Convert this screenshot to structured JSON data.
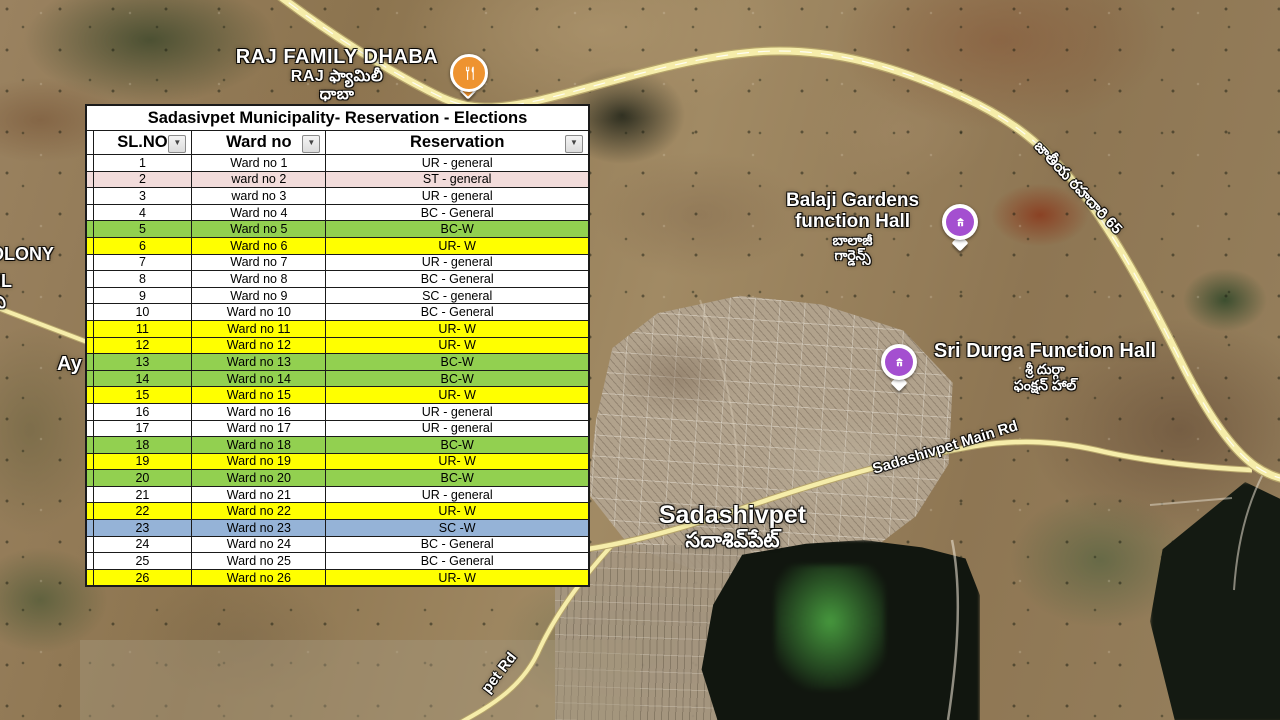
{
  "table": {
    "title": "Sadasivpet Municipality- Reservation - Elections",
    "columns": {
      "sl": "SL.NO",
      "ward": "Ward no",
      "res": "Reservation"
    },
    "filter_icon": "▼",
    "row_colors": {
      "white": "#ffffff",
      "pink": "#f2dcdb",
      "green": "#92d050",
      "yellow": "#ffff00",
      "blue": "#95b3d7",
      "pink_text": "#ff0000"
    },
    "rows": [
      {
        "sl": "1",
        "ward": "Ward no 1",
        "res": "UR - general",
        "fill": "white"
      },
      {
        "sl": "2",
        "ward": "ward no 2",
        "res": "ST - general",
        "fill": "pink"
      },
      {
        "sl": "3",
        "ward": "ward no 3",
        "res": "UR - general",
        "fill": "white"
      },
      {
        "sl": "4",
        "ward": "Ward no 4",
        "res": "BC - General",
        "fill": "white"
      },
      {
        "sl": "5",
        "ward": "Ward no 5",
        "res": "BC-W",
        "fill": "green"
      },
      {
        "sl": "6",
        "ward": "Ward no 6",
        "res": "UR- W",
        "fill": "yellow"
      },
      {
        "sl": "7",
        "ward": "Ward no 7",
        "res": "UR - general",
        "fill": "white"
      },
      {
        "sl": "8",
        "ward": "Ward no 8",
        "res": "BC - General",
        "fill": "white"
      },
      {
        "sl": "9",
        "ward": "Ward no 9",
        "res": "SC - general",
        "fill": "white"
      },
      {
        "sl": "10",
        "ward": "Ward no 10",
        "res": "BC - General",
        "fill": "white"
      },
      {
        "sl": "11",
        "ward": "Ward no 11",
        "res": "UR- W",
        "fill": "yellow"
      },
      {
        "sl": "12",
        "ward": "Ward no 12",
        "res": "UR- W",
        "fill": "yellow"
      },
      {
        "sl": "13",
        "ward": "Ward no 13",
        "res": "BC-W",
        "fill": "green"
      },
      {
        "sl": "14",
        "ward": "Ward no 14",
        "res": "BC-W",
        "fill": "green"
      },
      {
        "sl": "15",
        "ward": "Ward no 15",
        "res": "UR- W",
        "fill": "yellow"
      },
      {
        "sl": "16",
        "ward": "Ward no 16",
        "res": "UR - general",
        "fill": "white"
      },
      {
        "sl": "17",
        "ward": "Ward no 17",
        "res": "UR - general",
        "fill": "white"
      },
      {
        "sl": "18",
        "ward": "Ward no 18",
        "res": "BC-W",
        "fill": "green"
      },
      {
        "sl": "19",
        "ward": "Ward no 19",
        "res": "UR- W",
        "fill": "yellow"
      },
      {
        "sl": "20",
        "ward": "Ward no 20",
        "res": "BC-W",
        "fill": "green"
      },
      {
        "sl": "21",
        "ward": "Ward no 21",
        "res": "UR - general",
        "fill": "white"
      },
      {
        "sl": "22",
        "ward": "Ward no 22",
        "res": "UR- W",
        "fill": "yellow"
      },
      {
        "sl": "23",
        "ward": "Ward no 23",
        "res": "SC -W",
        "fill": "blue"
      },
      {
        "sl": "24",
        "ward": "Ward no 24",
        "res": "BC - General",
        "fill": "white"
      },
      {
        "sl": "25",
        "ward": "Ward no 25",
        "res": "BC - General",
        "fill": "white"
      },
      {
        "sl": "26",
        "ward": "Ward no 26",
        "res": "UR- W",
        "fill": "yellow"
      }
    ]
  },
  "map": {
    "labels": {
      "dhaba_en": "RAJ FAMILY DHABA",
      "dhaba_te1": "RAJ ఫ్యామిలీ",
      "dhaba_te2": "ధాబా",
      "balaji_1": "Balaji Gardens",
      "balaji_2": "function Hall",
      "balaji_te1": "బాలాజీ",
      "balaji_te2": "గార్డెన్స్",
      "durga_en": "Sri Durga Function Hall",
      "durga_te1": "శ్రీ దుర్గా",
      "durga_te2": "ఫంక్షన్ హాల్",
      "town_en": "Sadashivpet",
      "town_te": "సదాశివ్‌పేట్",
      "main_rd": "Sadashivpet Main Rd",
      "nh65_te": "జాతీయ రహదారి 65",
      "pet_rd": "pet Rd",
      "colony_partial": "OLONY",
      "ml_partial": "ML",
      "telugu_partial": "ని",
      "ay_partial": "Ay"
    },
    "colors": {
      "road_fill": "#f6edaa",
      "road_casing": "#b5a36a",
      "pin_purple": "#a44fd0",
      "pin_orange": "#ee9330",
      "lake": "#11160f"
    }
  }
}
